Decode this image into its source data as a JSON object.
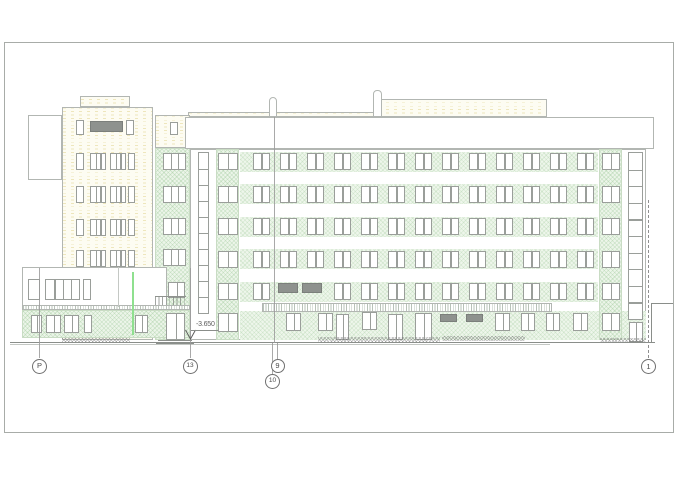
{
  "annotations": {
    "level_text": "-3.650"
  },
  "palette": {
    "line": "#b2b6b2",
    "window_frame": "#9a9e9a",
    "dark_fill": "#8e928e",
    "green_fill": "#ecf5e9",
    "green_hatch": "#8cbe87",
    "yellow_fill": "#fdfcf2",
    "yellow_dash": "#ded187",
    "accent_green_line": "#8fe08f",
    "ground_line": "#8a8e8a",
    "text": "#4a4a4a"
  },
  "drawing": {
    "frame": {
      "x": 4,
      "y": 42,
      "w": 670,
      "h": 391
    },
    "boxes": [
      {
        "n": "roof-structure-low",
        "x": 188,
        "y": 112,
        "w": 189,
        "h": 5,
        "f": "y"
      },
      {
        "n": "roof-structure-high",
        "x": 377,
        "y": 99,
        "w": 170,
        "h": 18,
        "f": "y"
      },
      {
        "n": "vent-pipe",
        "x": 269,
        "y": 97,
        "w": 8,
        "h": 20,
        "f": "w",
        "r": true
      },
      {
        "n": "vent-pipe",
        "x": 373,
        "y": 90,
        "w": 9,
        "h": 27,
        "f": "w",
        "r": true
      },
      {
        "n": "tower-parapet-box",
        "x": 80,
        "y": 96,
        "w": 50,
        "h": 11,
        "f": "y"
      },
      {
        "n": "stair-tower-rear",
        "x": 28,
        "y": 115,
        "w": 34,
        "h": 65,
        "f": "w"
      },
      {
        "n": "left-tower",
        "x": 62,
        "y": 107,
        "w": 91,
        "h": 233,
        "f": "y"
      },
      {
        "n": "link-wall-upper",
        "x": 155,
        "y": 115,
        "w": 35,
        "h": 33,
        "f": "y"
      },
      {
        "n": "link-wall-lower",
        "x": 155,
        "y": 148,
        "w": 35,
        "h": 192,
        "f": "g"
      },
      {
        "n": "main-facade",
        "x": 190,
        "y": 149,
        "w": 456,
        "h": 191,
        "f": "w"
      }
    ],
    "green_bands": [
      {
        "x": 240,
        "y": 151.5,
        "w": 358,
        "h": 20
      },
      {
        "x": 240,
        "y": 184,
        "w": 358,
        "h": 20
      },
      {
        "x": 240,
        "y": 216.5,
        "w": 358,
        "h": 20
      },
      {
        "x": 240,
        "y": 249,
        "w": 358,
        "h": 20
      },
      {
        "x": 240,
        "y": 281.5,
        "w": 358,
        "h": 20
      },
      {
        "x": 240,
        "y": 311,
        "w": 406,
        "h": 29
      }
    ],
    "strips": [
      {
        "n": "left-stair-strip",
        "x": 216,
        "y": 149,
        "w": 23,
        "h": 191
      },
      {
        "n": "right-stair-strip",
        "x": 599,
        "y": 149,
        "w": 23,
        "h": 191
      }
    ],
    "overlays": [
      {
        "n": "parapet-band",
        "x": 185,
        "y": 117,
        "w": 469,
        "h": 32,
        "f": "w"
      },
      {
        "n": "canopy",
        "x": 262,
        "y": 303,
        "w": 290,
        "h": 9,
        "f": "w",
        "tick": true
      },
      {
        "n": "annex-upper",
        "x": 22,
        "y": 267,
        "w": 145,
        "h": 40,
        "f": "w"
      },
      {
        "n": "annex-fascia",
        "x": 22,
        "y": 305,
        "w": 168,
        "h": 5,
        "f": "w",
        "tick": true
      },
      {
        "n": "annex-ground",
        "x": 22,
        "y": 310,
        "w": 168,
        "h": 28,
        "f": "g"
      }
    ],
    "window_grid": {
      "cols": [
        253,
        280,
        307,
        334,
        361,
        388,
        415,
        442,
        469,
        496,
        523,
        550,
        577
      ],
      "col_w": 16.5,
      "rows": [
        153,
        185.5,
        218,
        250.5,
        283
      ],
      "row_h": 17,
      "mullions": 1,
      "skip": [
        [
          1,
          4
        ],
        [
          2,
          4
        ]
      ]
    },
    "dark_panels": [
      {
        "n": "ribbon-window-dark",
        "x": 90,
        "y": 121,
        "w": 33,
        "h": 11
      },
      {
        "n": "dark-panel",
        "x": 278,
        "y": 283,
        "w": 20,
        "h": 9.5
      },
      {
        "n": "dark-panel",
        "x": 302,
        "y": 283,
        "w": 20,
        "h": 9.5
      },
      {
        "n": "dark-transom",
        "x": 440,
        "y": 314,
        "w": 17,
        "h": 8
      },
      {
        "n": "dark-transom",
        "x": 466,
        "y": 314,
        "w": 17,
        "h": 8
      }
    ],
    "windows": [
      {
        "x": 218,
        "y": 153,
        "w": 20,
        "h": 17,
        "m": 1
      },
      {
        "x": 218,
        "y": 185.5,
        "w": 20,
        "h": 17,
        "m": 1
      },
      {
        "x": 218,
        "y": 218,
        "w": 20,
        "h": 17,
        "m": 1
      },
      {
        "x": 218,
        "y": 250.5,
        "w": 20,
        "h": 17,
        "m": 1
      },
      {
        "x": 218,
        "y": 283,
        "w": 20,
        "h": 17,
        "m": 1
      },
      {
        "x": 218,
        "y": 313,
        "w": 20,
        "h": 19,
        "m": 1
      },
      {
        "x": 602,
        "y": 153,
        "w": 18,
        "h": 17,
        "m": 1
      },
      {
        "x": 602,
        "y": 185.5,
        "w": 18,
        "h": 17,
        "m": 1
      },
      {
        "x": 602,
        "y": 218,
        "w": 18,
        "h": 17,
        "m": 1
      },
      {
        "x": 602,
        "y": 250.5,
        "w": 18,
        "h": 17,
        "m": 1
      },
      {
        "x": 602,
        "y": 283,
        "w": 18,
        "h": 17,
        "m": 1
      },
      {
        "x": 602,
        "y": 313,
        "w": 18,
        "h": 18,
        "m": 1
      },
      {
        "x": 163,
        "y": 153,
        "w": 23,
        "h": 17,
        "m": 2
      },
      {
        "x": 163,
        "y": 185.5,
        "w": 23,
        "h": 17,
        "m": 2
      },
      {
        "x": 163,
        "y": 218,
        "w": 23,
        "h": 17,
        "m": 2
      },
      {
        "x": 163,
        "y": 249,
        "w": 23,
        "h": 17,
        "m": 2
      },
      {
        "x": 168,
        "y": 282,
        "w": 17,
        "h": 16,
        "m": 1
      },
      {
        "x": 166,
        "y": 313,
        "w": 19,
        "h": 27,
        "m": 1
      },
      {
        "x": 170,
        "y": 122,
        "w": 8,
        "h": 13,
        "m": 0
      },
      {
        "x": 76,
        "y": 120,
        "w": 8,
        "h": 15,
        "m": 0
      },
      {
        "x": 126,
        "y": 120,
        "w": 8,
        "h": 15,
        "m": 0
      },
      {
        "x": 76,
        "y": 153,
        "w": 8,
        "h": 17,
        "m": 0
      },
      {
        "x": 90,
        "y": 153,
        "w": 16,
        "h": 17,
        "m": 2
      },
      {
        "x": 110,
        "y": 153,
        "w": 16,
        "h": 17,
        "m": 2
      },
      {
        "x": 128,
        "y": 153,
        "w": 7,
        "h": 17,
        "m": 0
      },
      {
        "x": 76,
        "y": 186,
        "w": 8,
        "h": 17,
        "m": 0
      },
      {
        "x": 90,
        "y": 186,
        "w": 16,
        "h": 17,
        "m": 2
      },
      {
        "x": 110,
        "y": 186,
        "w": 16,
        "h": 17,
        "m": 2
      },
      {
        "x": 128,
        "y": 186,
        "w": 7,
        "h": 17,
        "m": 0
      },
      {
        "x": 76,
        "y": 219,
        "w": 8,
        "h": 17,
        "m": 0
      },
      {
        "x": 90,
        "y": 219,
        "w": 16,
        "h": 17,
        "m": 2
      },
      {
        "x": 110,
        "y": 219,
        "w": 16,
        "h": 17,
        "m": 2
      },
      {
        "x": 128,
        "y": 219,
        "w": 7,
        "h": 17,
        "m": 0
      },
      {
        "x": 76,
        "y": 250,
        "w": 8,
        "h": 17,
        "m": 0
      },
      {
        "x": 90,
        "y": 250,
        "w": 16,
        "h": 17,
        "m": 2
      },
      {
        "x": 110,
        "y": 250,
        "w": 16,
        "h": 17,
        "m": 2
      },
      {
        "x": 128,
        "y": 250,
        "w": 7,
        "h": 17,
        "m": 0
      },
      {
        "x": 28,
        "y": 279,
        "w": 12,
        "h": 21,
        "m": 0
      },
      {
        "x": 45,
        "y": 279,
        "w": 35,
        "h": 21,
        "m": 3
      },
      {
        "x": 83,
        "y": 279,
        "w": 8,
        "h": 21,
        "m": 0
      },
      {
        "x": 31,
        "y": 315,
        "w": 11,
        "h": 18,
        "m": 1
      },
      {
        "x": 46,
        "y": 315,
        "w": 15,
        "h": 18,
        "m": 1
      },
      {
        "x": 64,
        "y": 315,
        "w": 15,
        "h": 18,
        "m": 1
      },
      {
        "x": 84,
        "y": 315,
        "w": 8,
        "h": 18,
        "m": 0
      },
      {
        "x": 135,
        "y": 315,
        "w": 13,
        "h": 18,
        "m": 1
      },
      {
        "x": 286,
        "y": 313,
        "w": 15,
        "h": 18,
        "m": 1
      },
      {
        "x": 318,
        "y": 313,
        "w": 15,
        "h": 18,
        "m": 1
      },
      {
        "x": 336,
        "y": 314,
        "w": 13,
        "h": 26,
        "m": 1
      },
      {
        "x": 362,
        "y": 312,
        "w": 15,
        "h": 18,
        "m": 1
      },
      {
        "x": 388,
        "y": 314,
        "w": 15,
        "h": 26,
        "m": 1
      },
      {
        "x": 415,
        "y": 313,
        "w": 17,
        "h": 27,
        "m": 1
      },
      {
        "x": 495,
        "y": 313,
        "w": 15,
        "h": 18,
        "m": 1
      },
      {
        "x": 521,
        "y": 313,
        "w": 14,
        "h": 18,
        "m": 1
      },
      {
        "x": 546,
        "y": 313,
        "w": 14,
        "h": 18,
        "m": 1
      },
      {
        "x": 573,
        "y": 313,
        "w": 15,
        "h": 18,
        "m": 1
      },
      {
        "x": 629,
        "y": 322,
        "w": 14,
        "h": 20,
        "m": 1
      }
    ],
    "stacks": [
      {
        "n": "stair-glazing-left",
        "x": 198,
        "y": 152,
        "w": 11,
        "h": 162,
        "panes": 10
      },
      {
        "n": "stair-glazing-right",
        "x": 628,
        "y": 152,
        "w": 15,
        "h": 168,
        "panes": 10
      }
    ],
    "rail": {
      "n": "balcony-railing",
      "x": 155,
      "y": 296,
      "w": 31,
      "h": 9
    },
    "accent_line": {
      "n": "downpipe-green",
      "x": 132,
      "y": 272,
      "w": 2,
      "h": 63
    },
    "lines": [
      {
        "n": "ground-line",
        "x": 10,
        "y": 341.5,
        "w": 645,
        "h": 1.1,
        "c": "ln"
      },
      {
        "n": "ground-line-2",
        "x": 10,
        "y": 344,
        "w": 540,
        "h": 0.7,
        "c": "ln-light"
      },
      {
        "n": "entry-step",
        "x": 158,
        "y": 340,
        "w": 34,
        "h": 0.8,
        "c": "ln"
      },
      {
        "n": "entry-step",
        "x": 156,
        "y": 342.5,
        "w": 38,
        "h": 0.8,
        "c": "ln"
      },
      {
        "n": "retaining-wall-top",
        "x": 651,
        "y": 303,
        "w": 22,
        "h": 0.8,
        "c": "ln"
      },
      {
        "n": "retaining-wall",
        "x": 651,
        "y": 303,
        "w": 0.8,
        "h": 39,
        "c": "ln"
      },
      {
        "n": "annex-divider",
        "x": 118,
        "y": 267,
        "w": 0.8,
        "h": 40,
        "c": "ln-light"
      }
    ],
    "ramps": [
      {
        "x": 62,
        "y": 338,
        "w": 68,
        "h": 4
      },
      {
        "x": 318,
        "y": 337,
        "w": 122,
        "h": 5
      },
      {
        "x": 442,
        "y": 336,
        "w": 83,
        "h": 5
      },
      {
        "x": 600,
        "y": 338,
        "w": 46,
        "h": 4
      }
    ],
    "grid_lines": [
      {
        "x": 39.2,
        "y": 268,
        "h": 90,
        "style": "solid"
      },
      {
        "x": 189.7,
        "y": 268,
        "h": 90,
        "style": "solid"
      },
      {
        "x": 273.8,
        "y": 117,
        "h": 226,
        "style": "solid"
      },
      {
        "x": 277.2,
        "y": 343,
        "h": 16,
        "style": "solid"
      },
      {
        "x": 272.4,
        "y": 343,
        "h": 31,
        "style": "solid"
      },
      {
        "x": 648,
        "y": 200,
        "h": 158,
        "style": "dashdot"
      }
    ],
    "grid_bubbles": [
      {
        "label": "P",
        "x": 39.5,
        "y": 366,
        "r": 7.5
      },
      {
        "label": "13",
        "x": 190,
        "y": 366,
        "r": 7.5
      },
      {
        "label": "9",
        "x": 277.5,
        "y": 366,
        "r": 7
      },
      {
        "label": "10",
        "x": 272.5,
        "y": 381,
        "r": 7.5
      },
      {
        "label": "1",
        "x": 648.5,
        "y": 366.5,
        "r": 7.5
      }
    ],
    "level_mark": {
      "text_x": 196,
      "text_y": 321,
      "line_x": 191,
      "line_y": 329.5,
      "line_w": 27,
      "arrow_x": 184,
      "arrow_y": 329
    }
  }
}
